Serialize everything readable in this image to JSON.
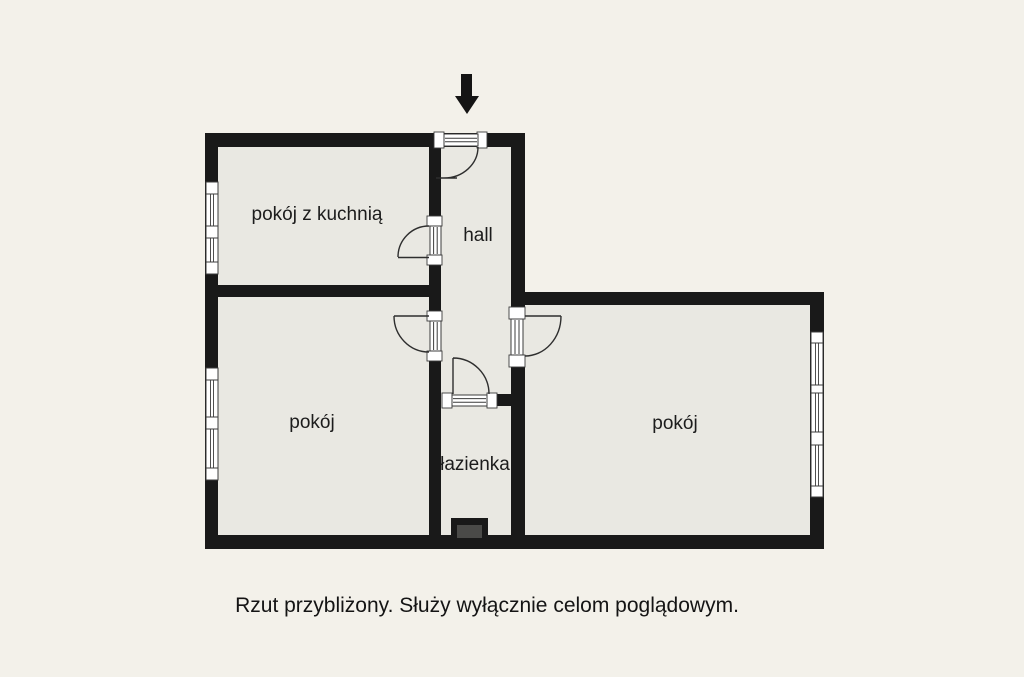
{
  "page": {
    "background_color": "#f3f1ea",
    "caption": "Rzut przybliżony. Służy wyłącznie celom poglądowym."
  },
  "floorplan": {
    "wall_color": "#191919",
    "room_fill_color": "#e9e8e2",
    "shaft_fill_color": "#4a4a48",
    "entrance_icon": "down-arrow",
    "rooms": [
      {
        "id": "room-with-kitchen",
        "label": "pokój z kuchnią"
      },
      {
        "id": "hall",
        "label": "hall"
      },
      {
        "id": "room-left",
        "label": "pokój"
      },
      {
        "id": "room-right",
        "label": "pokój"
      },
      {
        "id": "bathroom",
        "label": "łazienka"
      }
    ],
    "doors_count": 5,
    "windows_count": 3
  }
}
